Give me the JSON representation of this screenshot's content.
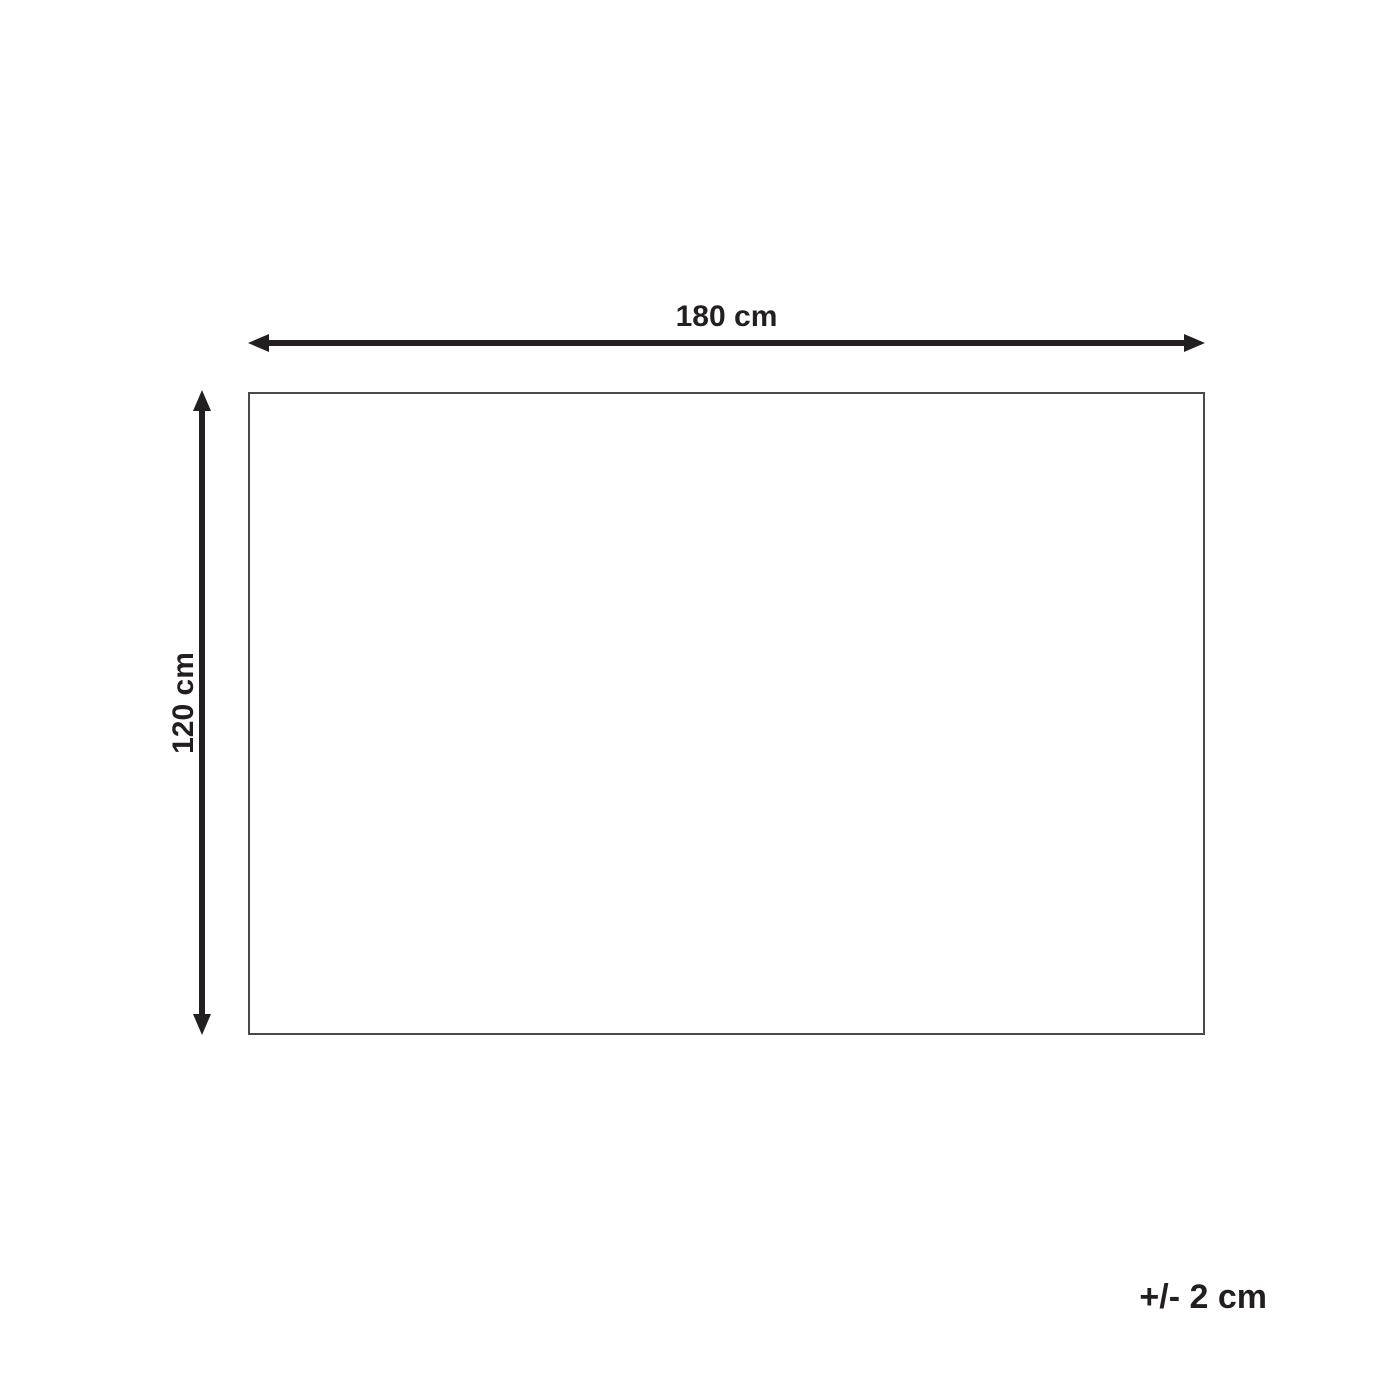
{
  "diagram": {
    "type": "product-dimensions",
    "width_label": "180 cm",
    "height_label": "120 cm",
    "tolerance_label": "+/- 2 cm",
    "colors": {
      "arrow": "#231f20",
      "rect_border": "#4a4a4b",
      "background": "#ffffff",
      "text": "#231f20"
    }
  }
}
